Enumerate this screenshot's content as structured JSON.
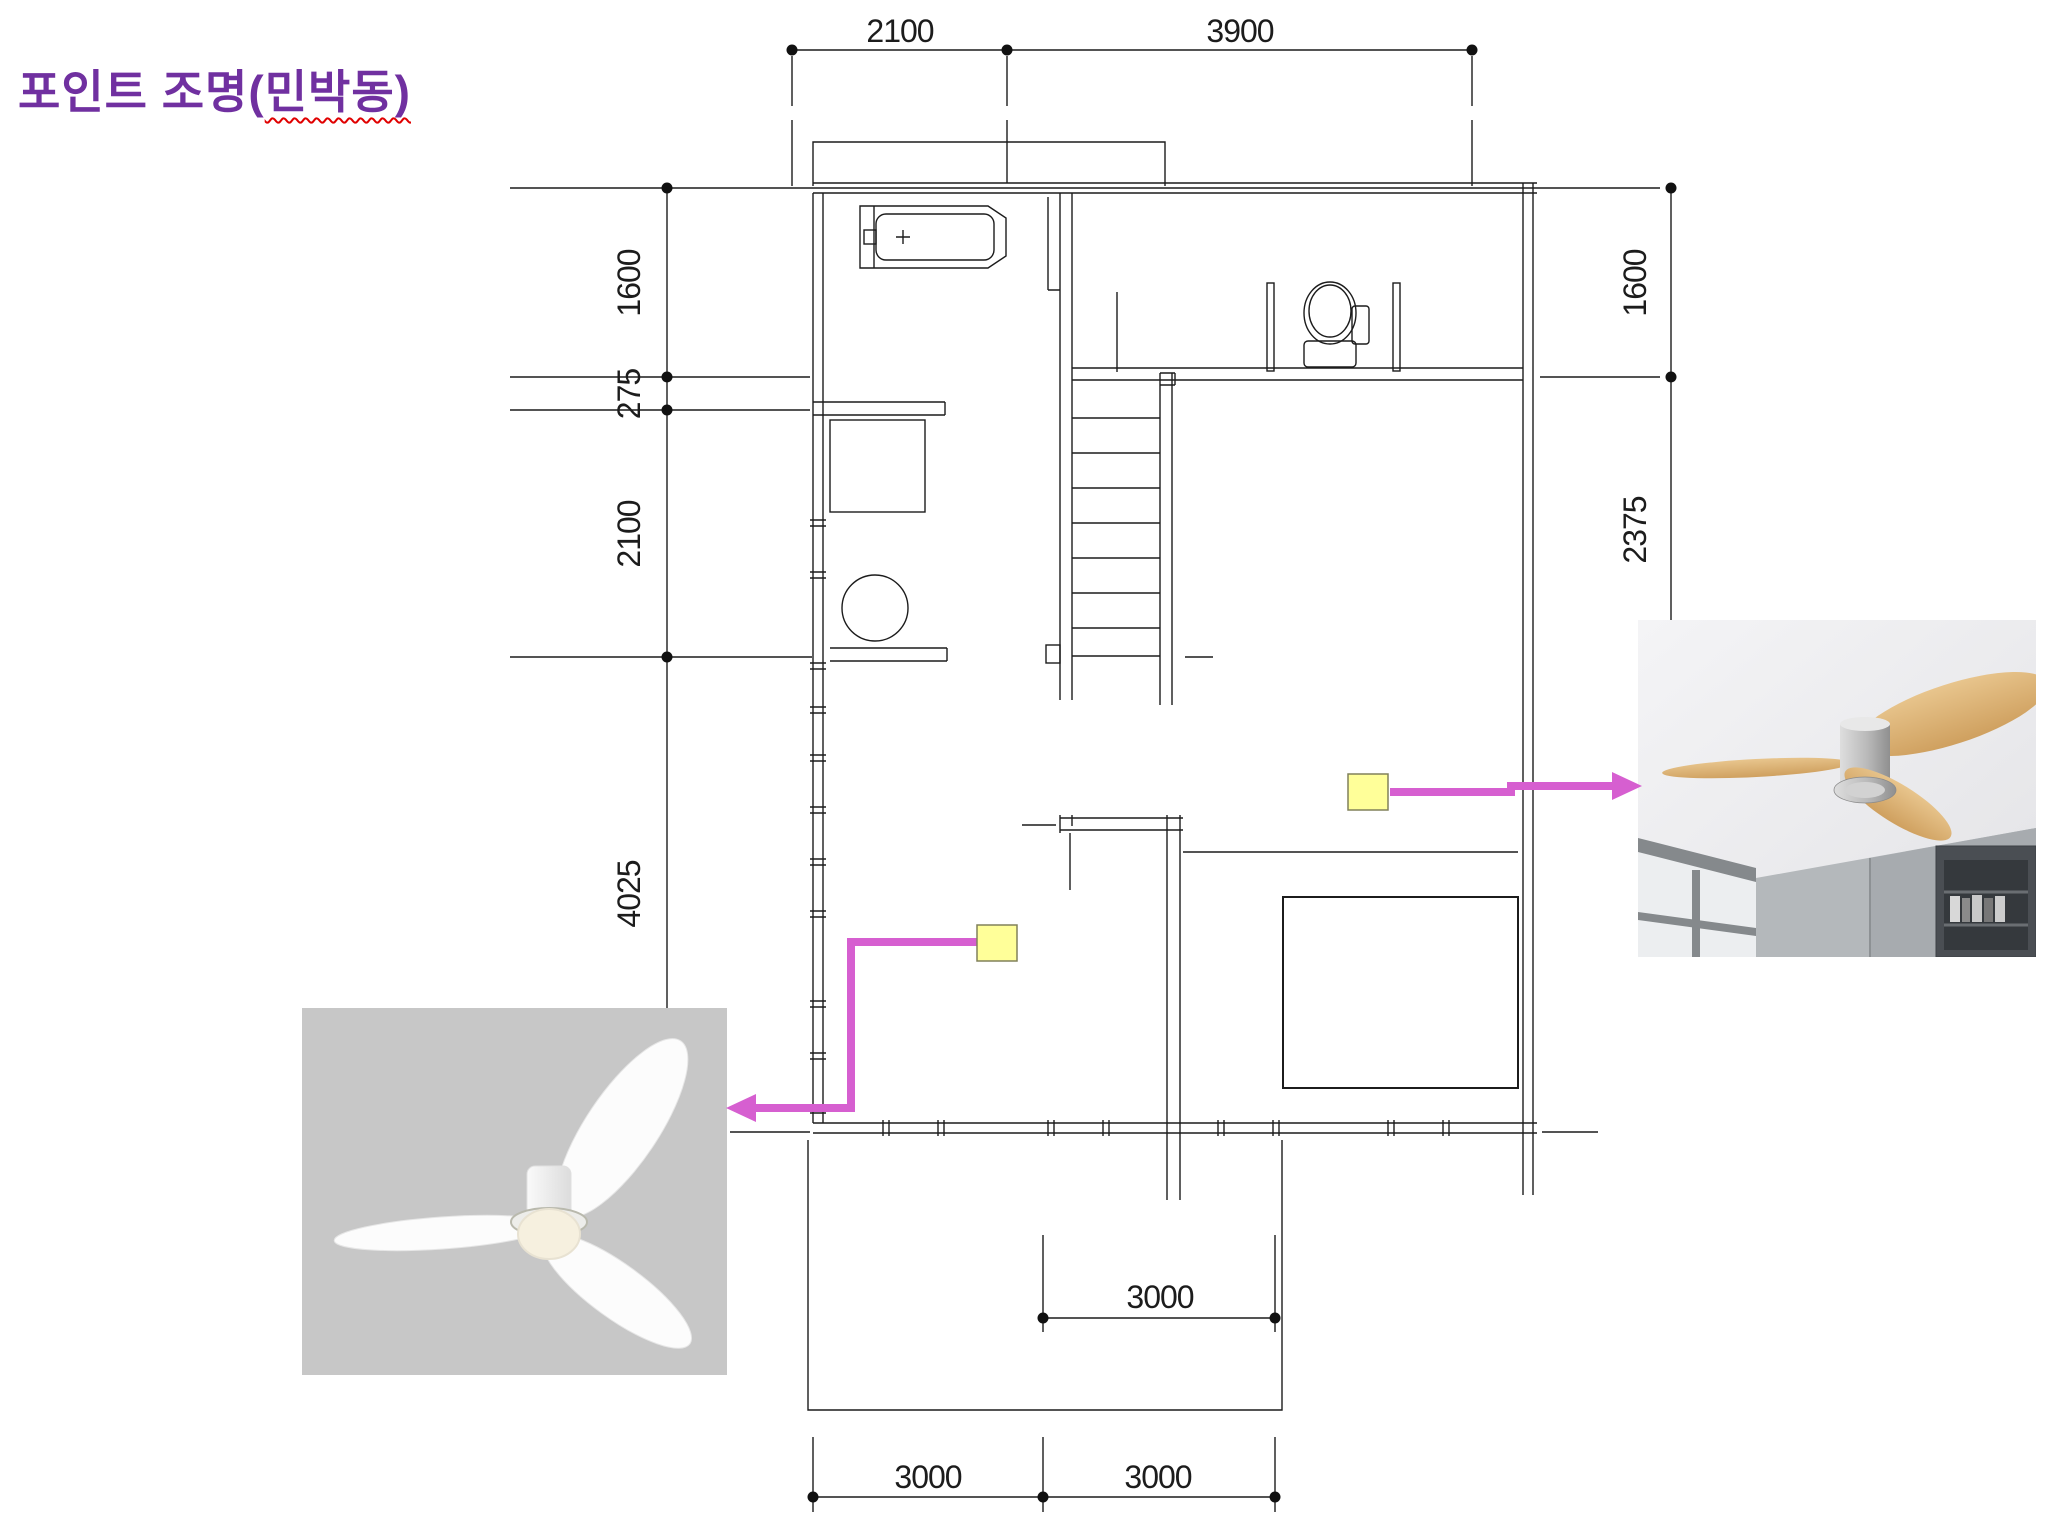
{
  "slide": {
    "background": "#FFFFFF"
  },
  "title": {
    "pre": "포인트 조명(",
    "highlighted": "민박동)",
    "color": "#7030A0",
    "underline_style": "red wavy spellcheck underline"
  },
  "floor_plan": {
    "line_color": "#1C1C1C",
    "dims": {
      "top": [
        "2100",
        "3900"
      ],
      "left": [
        "1600",
        "275",
        "2100",
        "4025"
      ],
      "right": [
        "1600",
        "2375"
      ],
      "bottom": [
        "3000",
        "3000"
      ],
      "inner_bottom": [
        "3000"
      ]
    },
    "fixtures": [
      "sink",
      "toilet",
      "stairs",
      "closet",
      "washing-machine",
      "bed",
      "deck",
      "window-walls"
    ]
  },
  "annotations": {
    "marker_fill": "#FFFF99",
    "marker_border": "#80805A",
    "arrow_color": "#D65FD0",
    "markers": [
      {
        "id": "living-area-fan-marker",
        "points_to": "white-ceiling-fan-photo"
      },
      {
        "id": "bedroom-fan-marker",
        "points_to": "wood-ceiling-fan-photo"
      }
    ]
  },
  "photos": {
    "white_fan": {
      "bg": "#C7C7C7",
      "blade_color": "#FCFCFC",
      "light_color": "#F6F0DF",
      "description": "white 3-blade flush ceiling fan with round light, on gray background"
    },
    "wood_fan": {
      "ceiling": "#F0F0F2",
      "wall": "#B4B8BB",
      "blade_color": "#DDB87E",
      "hub_color": "#ABABAB",
      "description": "wood 3-blade flush ceiling fan with silver hub, room corner with window and dark bookshelf"
    }
  }
}
